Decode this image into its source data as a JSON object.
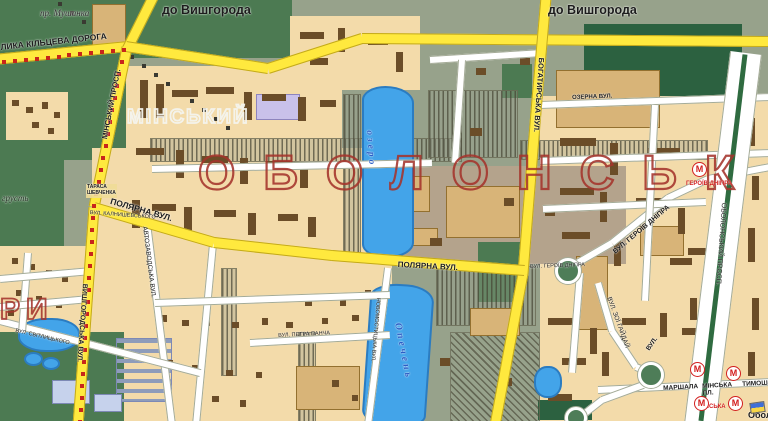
{
  "map": {
    "directions": {
      "to_vyshhorod_1": "до Вишгорода",
      "to_vyshhorod_2": "до Вишгорода"
    },
    "districts": {
      "obolon_big": "ОБОЛОНСЬК",
      "minsky_outline": "МІНСЬКИЙ",
      "hory_partial": "РИ",
      "kyn_hrust": "грусть"
    },
    "roads": {
      "kiltseva": "ЛИКА КІЛЬЦЕВА ДОРОГА",
      "minsky_prosp": "МІНСЬКИЙ ПРОСП.",
      "bohatyrska": "БОГАТИРСЬКА ВУЛ.",
      "vyshhorodska": "ВИШГОРОДСЬКА ВУЛ.",
      "polyarna_west": "ПОЛЯРНА ВУЛ.",
      "polyarna_east": "ПОЛЯРНА ВУЛ.",
      "ozerna": "ОЗЕРНА ВУЛ.",
      "heroiv_dnipra_curve": "ВУЛ. ГЕРОЇВ ДНІПРА",
      "heroiv_dnipra_small": "ВУЛ. ГЕРОЇВ ДНІПРА",
      "obolonsky_prosp": "ОБОЛОНСЬКИЙ ПРОСП.",
      "avtozavodska": "АВТОЗАВОДСЬКА ВУЛ.",
      "novomostytska": "НОВОМОСТИЦЬКА ВУЛ.",
      "petra_pancha": "ВУЛ. ПЕТРА ПАНЧА",
      "svitlytskoho": "ВУЛ. СВІТЛИЦЬКОГО",
      "kalnyshevskoho": "ВУЛ. КАЛНИШЕВСЬКОГО",
      "zoi_haidai": "ВУЛ. ЗОЇ ГАЙДАЙ",
      "vul_abbrev": "ВУЛ.",
      "marshala": "МАРШАЛА",
      "tymoshenka": "ТИМОШЕНКА",
      "minska_pl": "МІНСЬКА\nПЛ.",
      "shevchenka_sq": "ТАРАСА\nШЕВЧЕНКА"
    },
    "water": {
      "river_top": "пр. Мушанка",
      "lake_upper": "озеро",
      "lake_lower": "Опечень"
    },
    "metro": {
      "letter": "М",
      "station_heroiv_dnipra": "ГЕРОЇВ ДНІПРА",
      "station_minska": "МІНСЬКА"
    },
    "corner_text": "Обол",
    "colors": {
      "park_green": "#4c7a52",
      "dark_green": "#2c6140",
      "residential_beige": "#f3dbaa",
      "background_grey_green": "#97a28b",
      "road_yellow": "#ffe93e",
      "water_blue": "#43a4e9",
      "boundary_red": "#c8251b",
      "district_letters_red": "#a5342c",
      "metro_red": "#d21f1f"
    }
  }
}
